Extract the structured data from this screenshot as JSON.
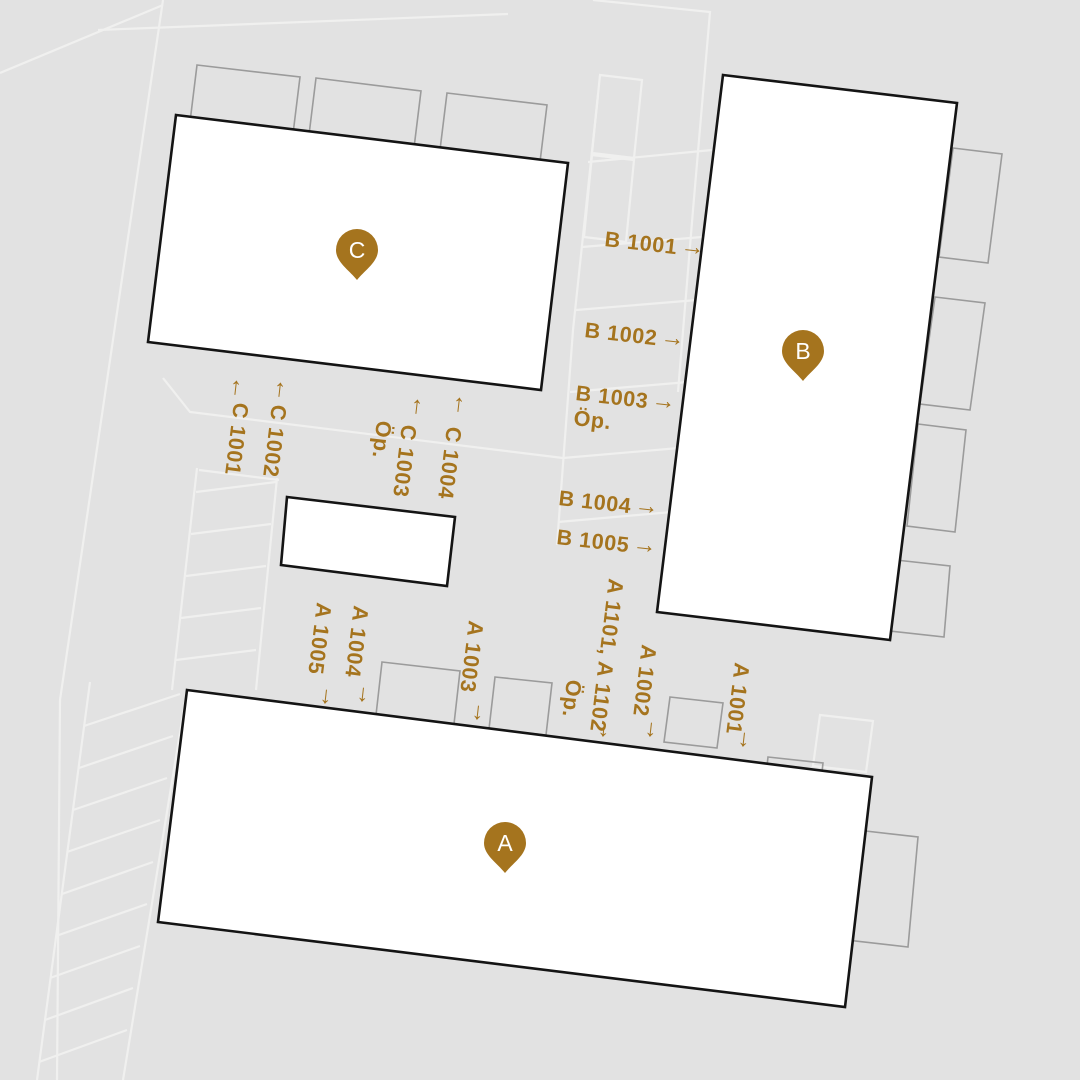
{
  "colors": {
    "accent": "#a5741e",
    "background": "#e2e2e2",
    "building_fill": "#ffffff",
    "building_stroke": "#141414",
    "parcel_line": "#f0f0ef",
    "block_outline": "#9b9b9b"
  },
  "glyphs": {
    "arrow_right": "→",
    "arrow_up": "↑",
    "arrow_down": "↓"
  },
  "pins": {
    "a": "A",
    "b": "B",
    "c": "C"
  },
  "units": {
    "b": [
      {
        "name": "B 1001"
      },
      {
        "name": "B 1002"
      },
      {
        "name": "B 1003",
        "note": "Öp."
      },
      {
        "name": "B 1004"
      },
      {
        "name": "B 1005"
      }
    ],
    "c": [
      {
        "name": "C 1001"
      },
      {
        "name": "C 1002"
      },
      {
        "name": "C 1003",
        "note": "Öp."
      },
      {
        "name": "C 1004"
      }
    ],
    "a": [
      {
        "name": "A 1005"
      },
      {
        "name": "A 1004"
      },
      {
        "name": "A 1003"
      },
      {
        "name": "A 1101, A 1102",
        "note": "Öp."
      },
      {
        "name": "A 1002"
      },
      {
        "name": "A 1001"
      }
    ]
  }
}
